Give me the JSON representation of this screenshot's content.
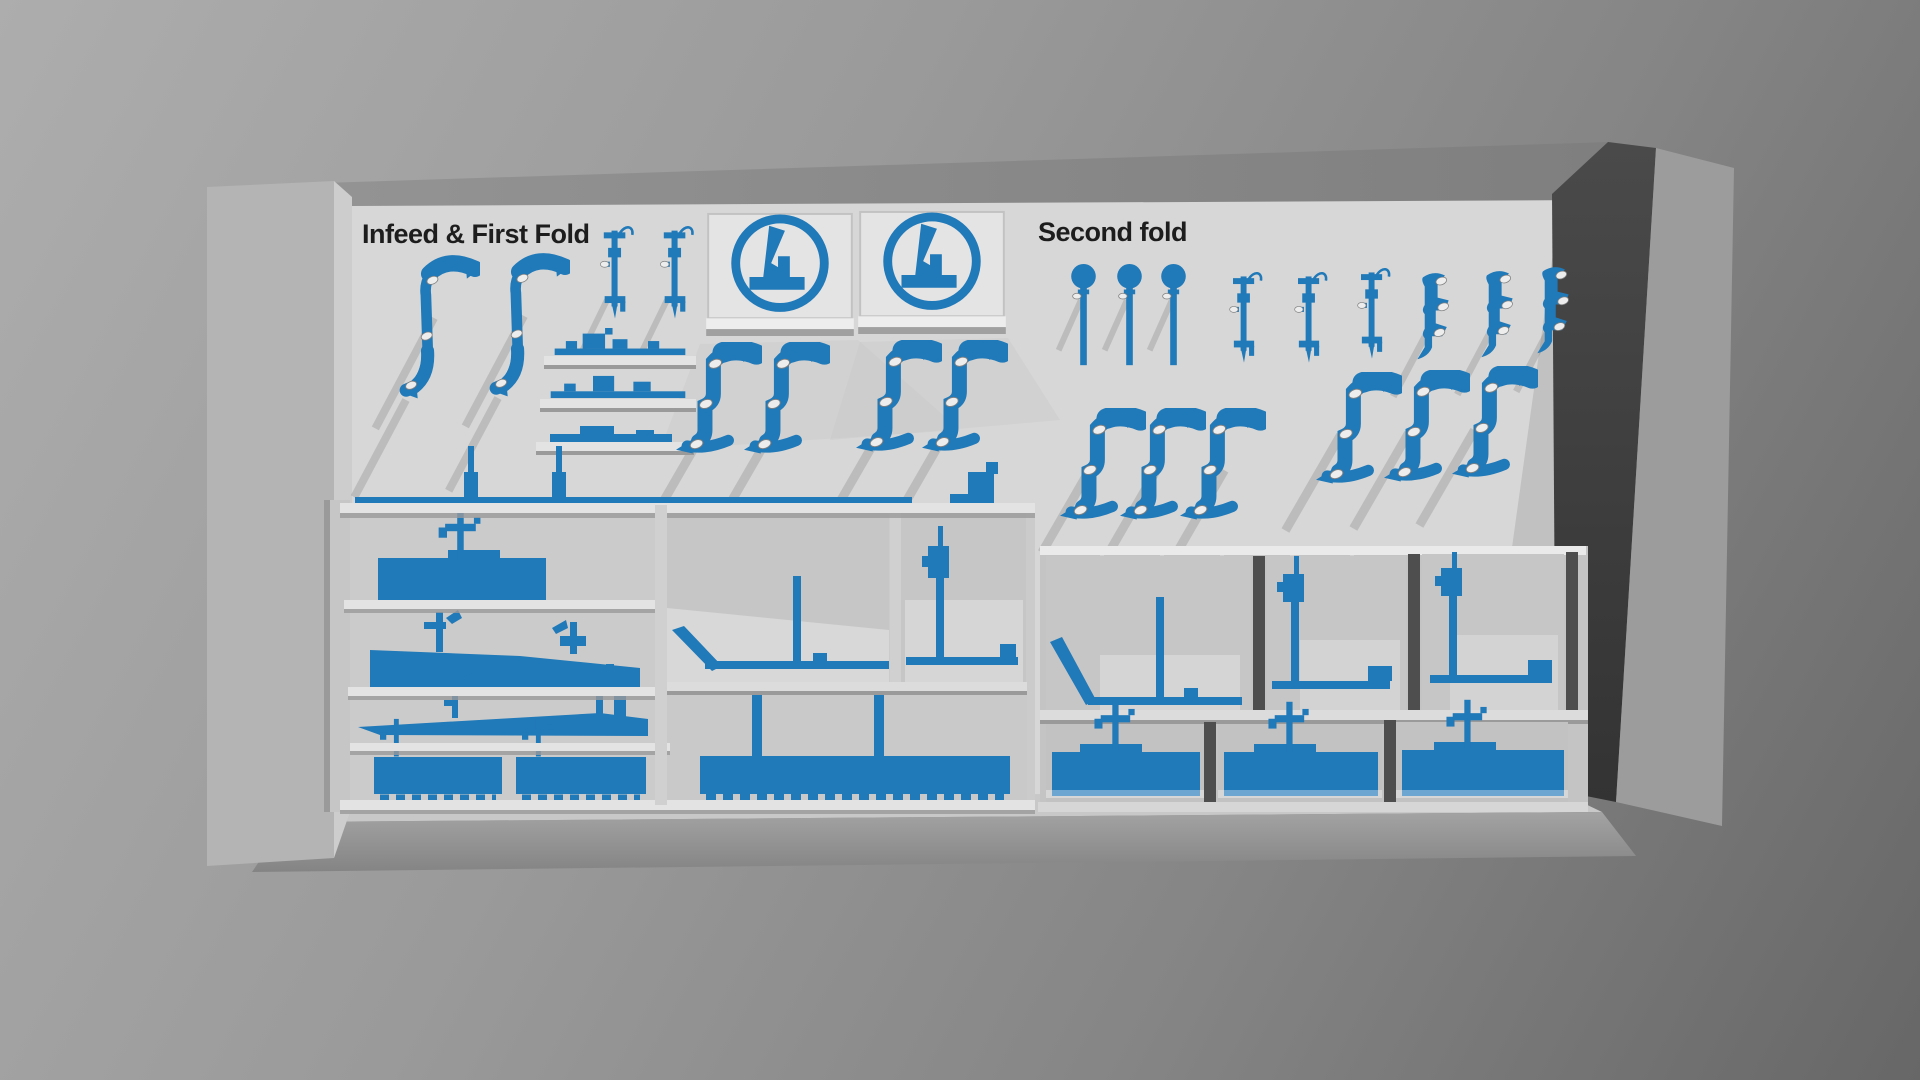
{
  "labels": {
    "infeed": "Infeed & First Fold",
    "second_fold": "Second fold"
  },
  "colors": {
    "tool_blue": "#2079b8",
    "tool_blue_dark": "#1a6397",
    "wall_light": "#d7d7d7",
    "ledge_light": "#e3e3e3",
    "compartment_gray": "#c6c6c6",
    "pillar_gray": "#b4b4b4",
    "pillar_dark_shadow": "#414141",
    "background_light": "#adadad",
    "background_dark": "#676767",
    "label_text": "#1d1d1d",
    "peg_metal": "#ededed"
  },
  "sections": [
    {
      "id": "infeed-first-fold",
      "label": "Infeed & First Fold",
      "wall_tools": [
        {
          "name": "c-clamp-hook",
          "count": 2
        },
        {
          "name": "vertical-caliper-tool",
          "count": 2
        },
        {
          "name": "crank-silhouette-panel",
          "count": 2
        },
        {
          "name": "fitting-shelf",
          "count": 3
        },
        {
          "name": "gooseneck-clamp",
          "count": 4
        },
        {
          "name": "mounting-rail",
          "count": 1
        },
        {
          "name": "rail-pin",
          "count": 2
        },
        {
          "name": "step-bracket",
          "count": 1
        }
      ],
      "shelf_tools": [
        {
          "name": "block-with-t-handle",
          "count": 1
        },
        {
          "name": "wedge-blade",
          "count": 1
        },
        {
          "name": "tapered-blade",
          "count": 1
        },
        {
          "name": "serrated-comb-tray",
          "count": 2
        },
        {
          "name": "large-serrated-comb-tray",
          "count": 1
        },
        {
          "name": "corner-guide-square",
          "count": 1
        },
        {
          "name": "post-guide",
          "count": 1
        }
      ]
    },
    {
      "id": "second-fold",
      "label": "Second fold",
      "wall_tools": [
        {
          "name": "ball-pin",
          "count": 3
        },
        {
          "name": "vertical-caliper-tool",
          "count": 3
        },
        {
          "name": "s-hook",
          "count": 3
        },
        {
          "name": "gooseneck-clamp",
          "count": 6
        }
      ],
      "cabinet_tools": [
        {
          "name": "corner-guide-square",
          "count": 1
        },
        {
          "name": "post-guide",
          "count": 2
        },
        {
          "name": "base-plate-with-t-handle",
          "count": 3
        }
      ]
    }
  ]
}
